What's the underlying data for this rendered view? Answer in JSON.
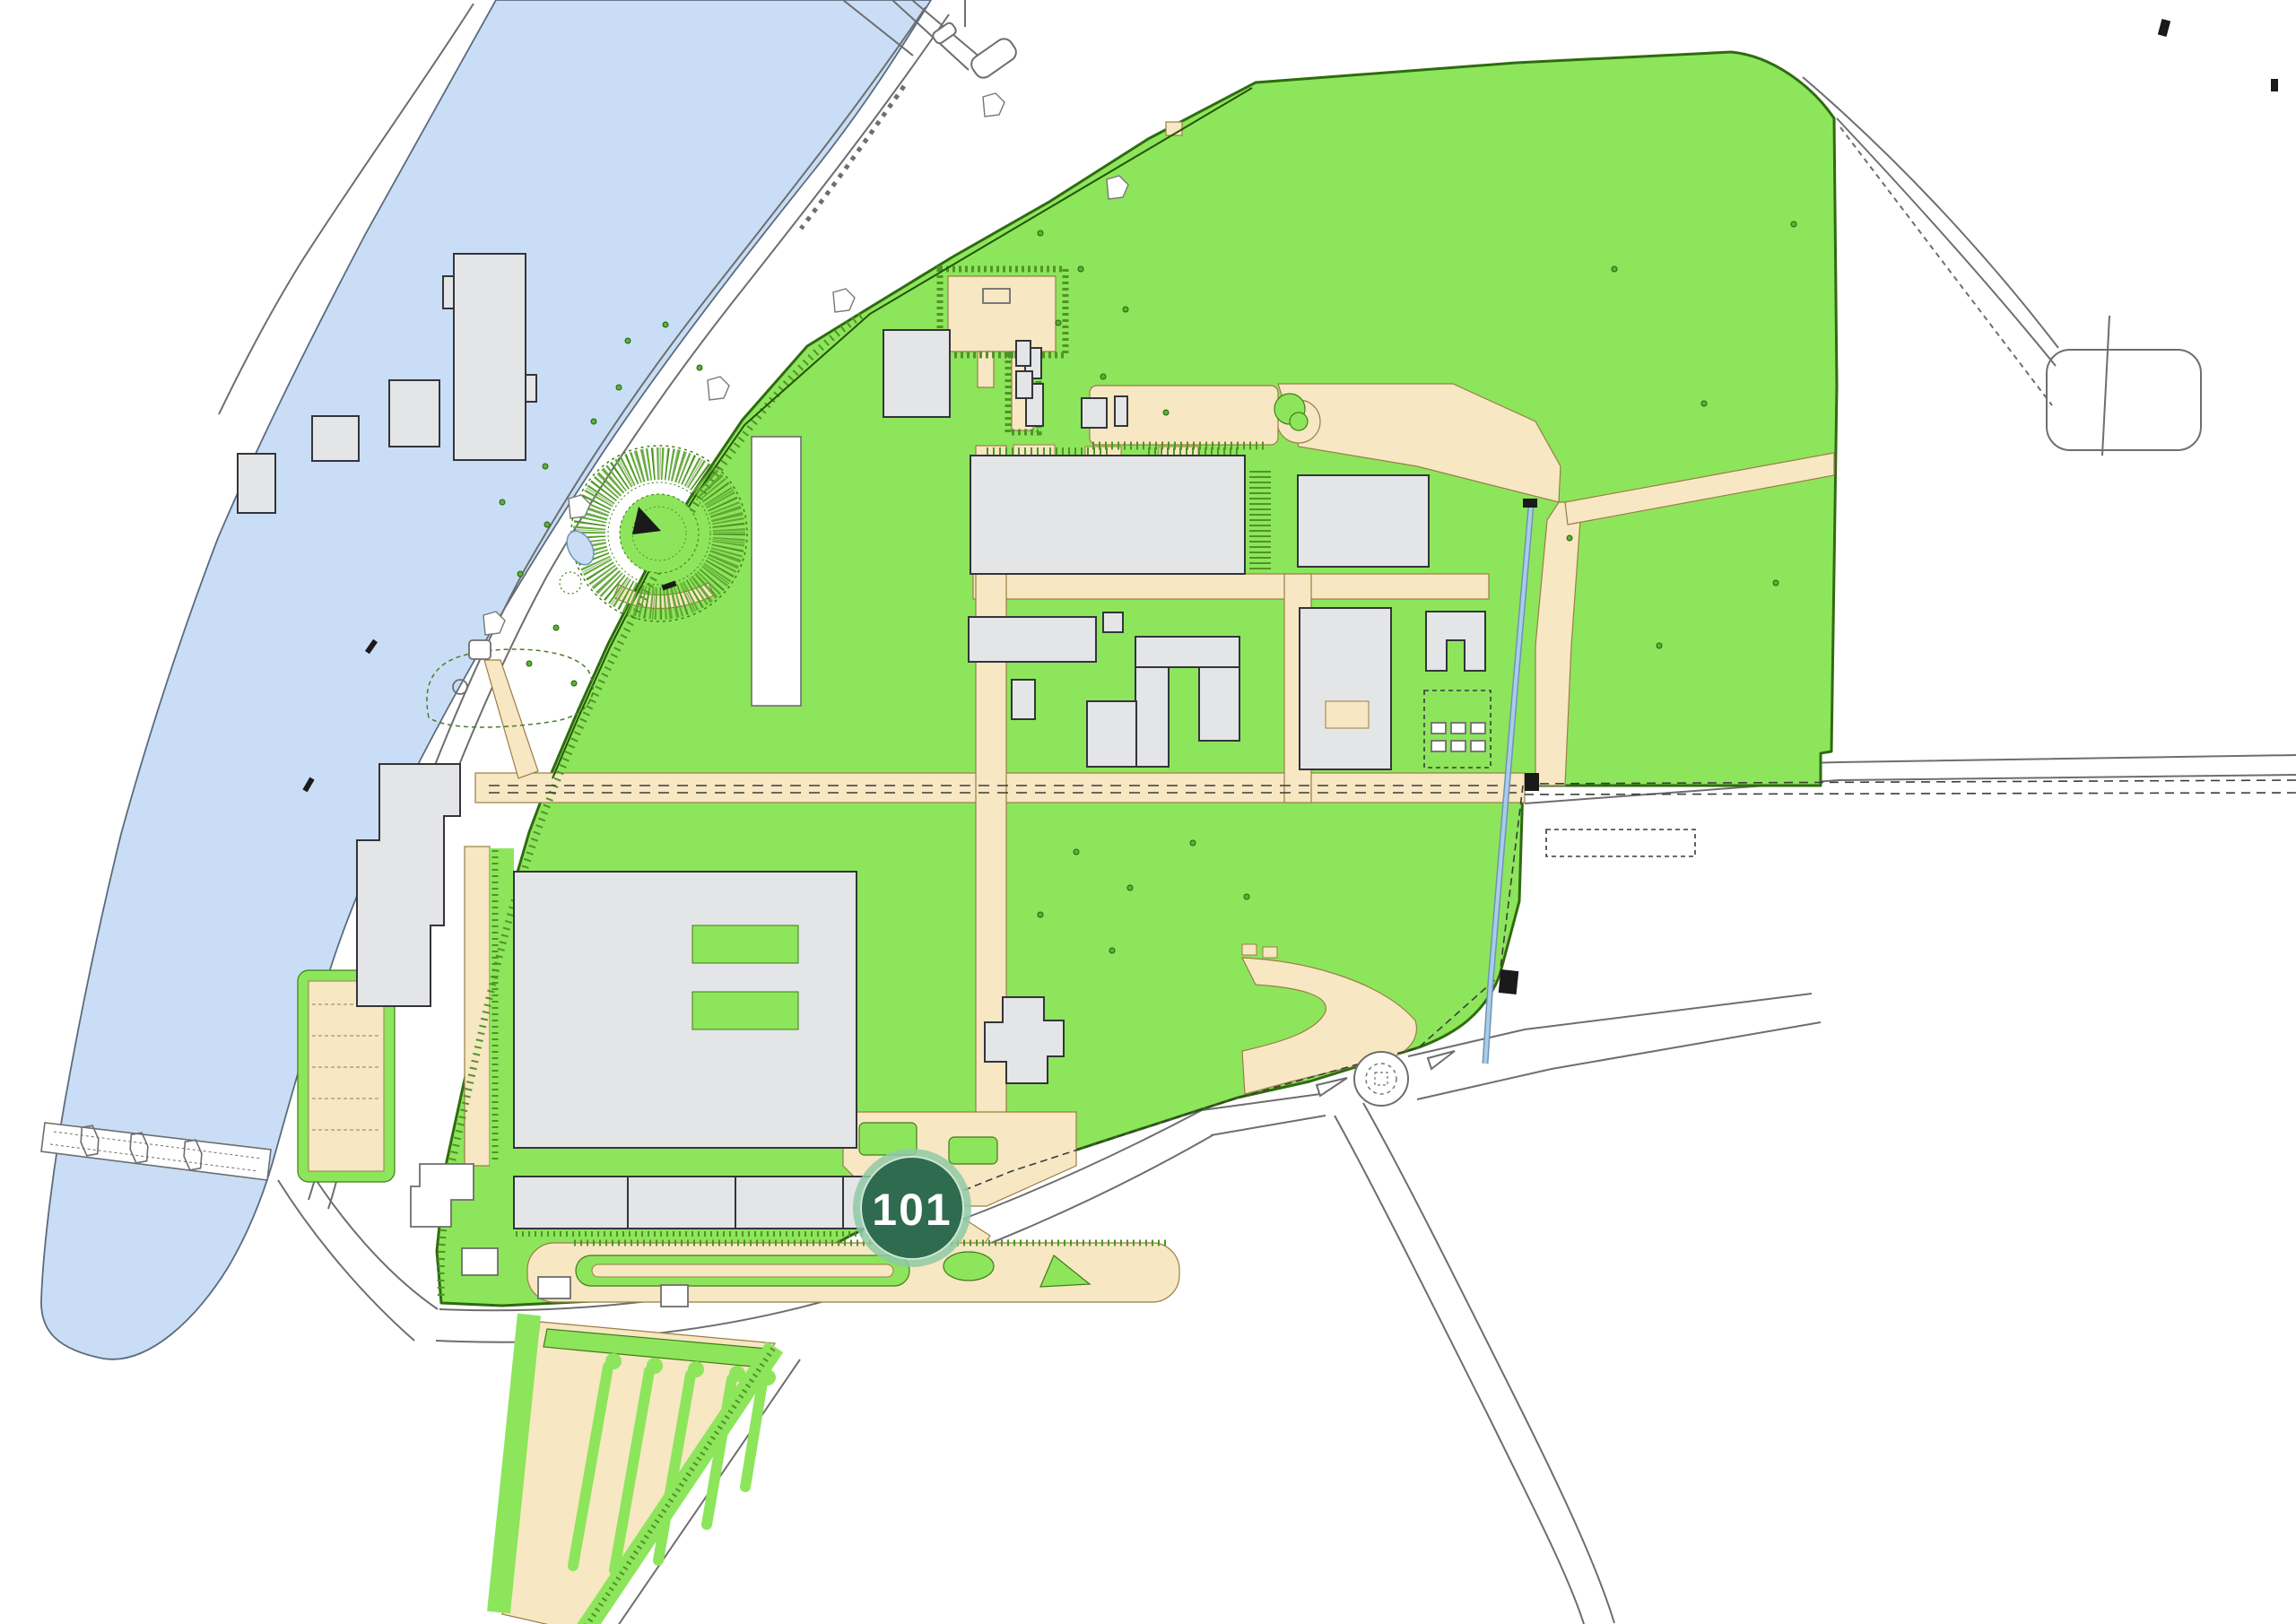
{
  "map": {
    "kind": "campus-site-plan",
    "background": "#FFFFFF"
  },
  "marker": {
    "label": "101"
  },
  "colors": {
    "water": "#C9DEF6",
    "water_edge": "#5B6B7C",
    "grass": "#8DE55C",
    "hedge": "#3F7D15",
    "hedge_dark": "#2F6B10",
    "hatch": "#4F9426",
    "paving": "#F7E7C3",
    "paving_edge": "#9A7E45",
    "building": "#E4E5E7",
    "building_edge": "#34343A",
    "road_line": "#6E6E6E",
    "marking": "#3C3C3C",
    "stream": "#A8CDE9",
    "stream_edge": "#6F93B5",
    "tree": "#57B52D",
    "tree_edge": "#2C5C12",
    "marker_fill": "#2F6B4E",
    "marker_halo": "#8FC9A4",
    "marker_text": "#FFFFFF",
    "black_detail": "#1A1A1A"
  }
}
